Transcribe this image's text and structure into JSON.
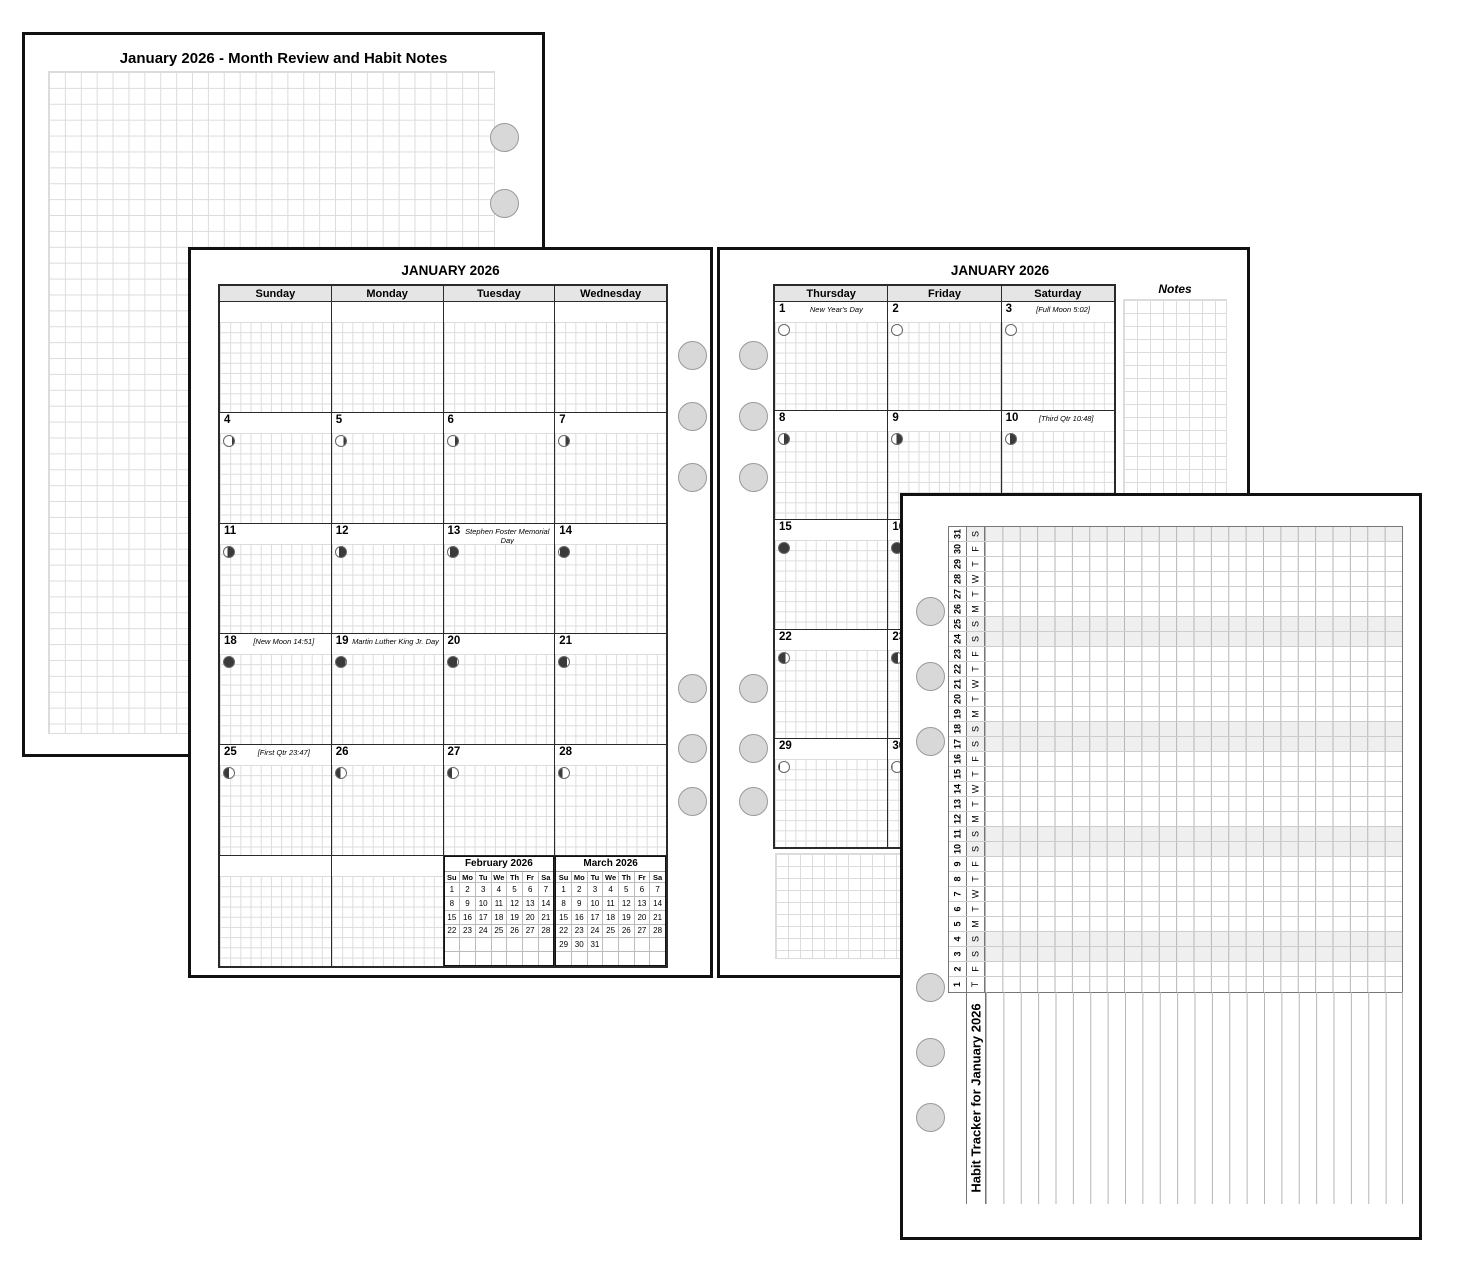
{
  "colors": {
    "page_border": "#111111",
    "grid_line": "#dcdcdc",
    "header_bg": "#e5e5e5",
    "hole_fill": "#d8d8d8",
    "weekend_shade": "#efefef",
    "moon_dark": "#3a3a3a"
  },
  "page1": {
    "title": "January 2026 - Month Review and Habit Notes"
  },
  "page2": {
    "title": "JANUARY 2026",
    "day_headers": [
      "Sunday",
      "Monday",
      "Tuesday",
      "Wednesday"
    ],
    "weeks": [
      [
        null,
        null,
        null,
        null
      ],
      [
        {
          "d": "4",
          "moon": {
            "side": "right",
            "dark": 20
          }
        },
        {
          "d": "5",
          "moon": {
            "side": "right",
            "dark": 25
          }
        },
        {
          "d": "6",
          "moon": {
            "side": "right",
            "dark": 30
          }
        },
        {
          "d": "7",
          "moon": {
            "side": "right",
            "dark": 35
          }
        }
      ],
      [
        {
          "d": "11",
          "moon": {
            "side": "right",
            "dark": 65
          }
        },
        {
          "d": "12",
          "moon": {
            "side": "right",
            "dark": 72
          }
        },
        {
          "d": "13",
          "holiday": "Stephen Foster Memorial Day",
          "moon": {
            "side": "right",
            "dark": 80
          }
        },
        {
          "d": "14",
          "moon": {
            "side": "right",
            "dark": 90
          }
        }
      ],
      [
        {
          "d": "18",
          "holiday": "[New Moon 14:51]",
          "moon": {
            "side": "right",
            "dark": 100
          }
        },
        {
          "d": "19",
          "holiday": "Martin Luther King Jr. Day",
          "moon": {
            "side": "left",
            "dark": 95
          }
        },
        {
          "d": "20",
          "moon": {
            "side": "left",
            "dark": 88
          }
        },
        {
          "d": "21",
          "moon": {
            "side": "left",
            "dark": 82
          }
        }
      ],
      [
        {
          "d": "25",
          "holiday": "[First Qtr 23:47]",
          "moon": {
            "side": "left",
            "dark": 50
          }
        },
        {
          "d": "26",
          "moon": {
            "side": "left",
            "dark": 45
          }
        },
        {
          "d": "27",
          "moon": {
            "side": "left",
            "dark": 40
          }
        },
        {
          "d": "28",
          "moon": {
            "side": "left",
            "dark": 33
          }
        }
      ]
    ],
    "mini_months": [
      {
        "title": "February 2026",
        "dow": [
          "Su",
          "Mo",
          "Tu",
          "We",
          "Th",
          "Fr",
          "Sa"
        ],
        "rows": [
          [
            "1",
            "2",
            "3",
            "4",
            "5",
            "6",
            "7"
          ],
          [
            "8",
            "9",
            "10",
            "11",
            "12",
            "13",
            "14"
          ],
          [
            "15",
            "16",
            "17",
            "18",
            "19",
            "20",
            "21"
          ],
          [
            "22",
            "23",
            "24",
            "25",
            "26",
            "27",
            "28"
          ],
          [
            "",
            "",
            "",
            "",
            "",
            "",
            ""
          ],
          [
            "",
            "",
            "",
            "",
            "",
            "",
            ""
          ]
        ]
      },
      {
        "title": "March 2026",
        "dow": [
          "Su",
          "Mo",
          "Tu",
          "We",
          "Th",
          "Fr",
          "Sa"
        ],
        "rows": [
          [
            "1",
            "2",
            "3",
            "4",
            "5",
            "6",
            "7"
          ],
          [
            "8",
            "9",
            "10",
            "11",
            "12",
            "13",
            "14"
          ],
          [
            "15",
            "16",
            "17",
            "18",
            "19",
            "20",
            "21"
          ],
          [
            "22",
            "23",
            "24",
            "25",
            "26",
            "27",
            "28"
          ],
          [
            "29",
            "30",
            "31",
            "",
            "",
            "",
            ""
          ],
          [
            "",
            "",
            "",
            "",
            "",
            "",
            ""
          ]
        ]
      }
    ]
  },
  "page3": {
    "title": "JANUARY 2026",
    "day_headers": [
      "Thursday",
      "Friday",
      "Saturday"
    ],
    "notes_label": "Notes",
    "weeks": [
      [
        {
          "d": "1",
          "holiday": "New Year's Day",
          "moon": {
            "side": "left",
            "dark": 0
          }
        },
        {
          "d": "2",
          "moon": {
            "side": "left",
            "dark": 0
          }
        },
        {
          "d": "3",
          "holiday": "[Full Moon 5:02]",
          "moon": {
            "side": "left",
            "dark": 0
          }
        }
      ],
      [
        {
          "d": "8",
          "moon": {
            "side": "right",
            "dark": 50
          }
        },
        {
          "d": "9",
          "moon": {
            "side": "right",
            "dark": 55
          }
        },
        {
          "d": "10",
          "holiday": "[Third Qtr 10:48]",
          "moon": {
            "side": "right",
            "dark": 60
          }
        }
      ],
      [
        {
          "d": "15",
          "moon": {
            "side": "right",
            "dark": 100
          }
        },
        {
          "d": "16",
          "moon": {
            "side": "right",
            "dark": 100
          }
        },
        null
      ],
      [
        {
          "d": "22",
          "moon": {
            "side": "left",
            "dark": 65
          }
        },
        {
          "d": "23",
          "moon": {
            "side": "left",
            "dark": 60
          }
        },
        null
      ],
      [
        {
          "d": "29",
          "moon": {
            "side": "left",
            "dark": 8
          }
        },
        {
          "d": "30",
          "moon": {
            "side": "left",
            "dark": 4
          }
        },
        null
      ]
    ]
  },
  "page4": {
    "title": "Habit Tracker for January 2026",
    "habit_cols": 24,
    "days": [
      {
        "n": "1",
        "w": "T"
      },
      {
        "n": "2",
        "w": "F"
      },
      {
        "n": "3",
        "w": "S"
      },
      {
        "n": "4",
        "w": "S"
      },
      {
        "n": "5",
        "w": "M"
      },
      {
        "n": "6",
        "w": "T"
      },
      {
        "n": "7",
        "w": "W"
      },
      {
        "n": "8",
        "w": "T"
      },
      {
        "n": "9",
        "w": "F"
      },
      {
        "n": "10",
        "w": "S"
      },
      {
        "n": "11",
        "w": "S"
      },
      {
        "n": "12",
        "w": "M"
      },
      {
        "n": "13",
        "w": "T"
      },
      {
        "n": "14",
        "w": "W"
      },
      {
        "n": "15",
        "w": "T"
      },
      {
        "n": "16",
        "w": "F"
      },
      {
        "n": "17",
        "w": "S"
      },
      {
        "n": "18",
        "w": "S"
      },
      {
        "n": "19",
        "w": "M"
      },
      {
        "n": "20",
        "w": "T"
      },
      {
        "n": "21",
        "w": "W"
      },
      {
        "n": "22",
        "w": "T"
      },
      {
        "n": "23",
        "w": "F"
      },
      {
        "n": "24",
        "w": "S"
      },
      {
        "n": "25",
        "w": "S"
      },
      {
        "n": "26",
        "w": "M"
      },
      {
        "n": "27",
        "w": "T"
      },
      {
        "n": "28",
        "w": "W"
      },
      {
        "n": "29",
        "w": "T"
      },
      {
        "n": "30",
        "w": "F"
      },
      {
        "n": "31",
        "w": "S"
      }
    ]
  }
}
